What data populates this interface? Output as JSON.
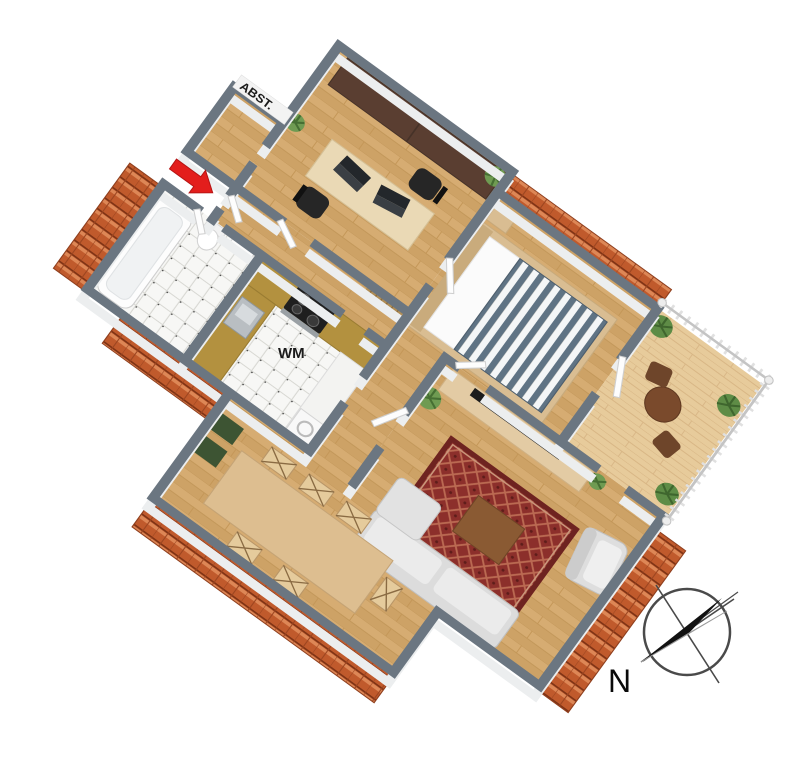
{
  "floor_plan": {
    "type": "3d-isometric-apartment-floor-plan",
    "labels": {
      "storage_room": "ABST.",
      "washing_machine": "WM",
      "compass_north": "N"
    },
    "compass": {
      "north_label": "N",
      "needle_direction": "lower-left"
    },
    "entrance": {
      "marker": "red-arrow",
      "color": "#e31e1c"
    },
    "colors": {
      "wall_top": "#6b7681",
      "wall_face": "#eceeef",
      "wood_floor": "#d2a76b",
      "balcony_deck": "#e7cb9b",
      "tile_floor": "#f7f7f5",
      "kitchen_counter": "#b3913f",
      "roof_tiles": "#c05a2c",
      "rug": "#8c2f2b",
      "bed_stripes": "#5f7384",
      "wardrobe": "#5a3e31",
      "sofa": "#dcdcdc",
      "dining_table": "#ddbe90"
    },
    "rooms_depicted": [
      "office",
      "storage",
      "bedroom",
      "balcony",
      "living-room",
      "bathroom",
      "kitchen",
      "hallway",
      "dining-area"
    ]
  }
}
